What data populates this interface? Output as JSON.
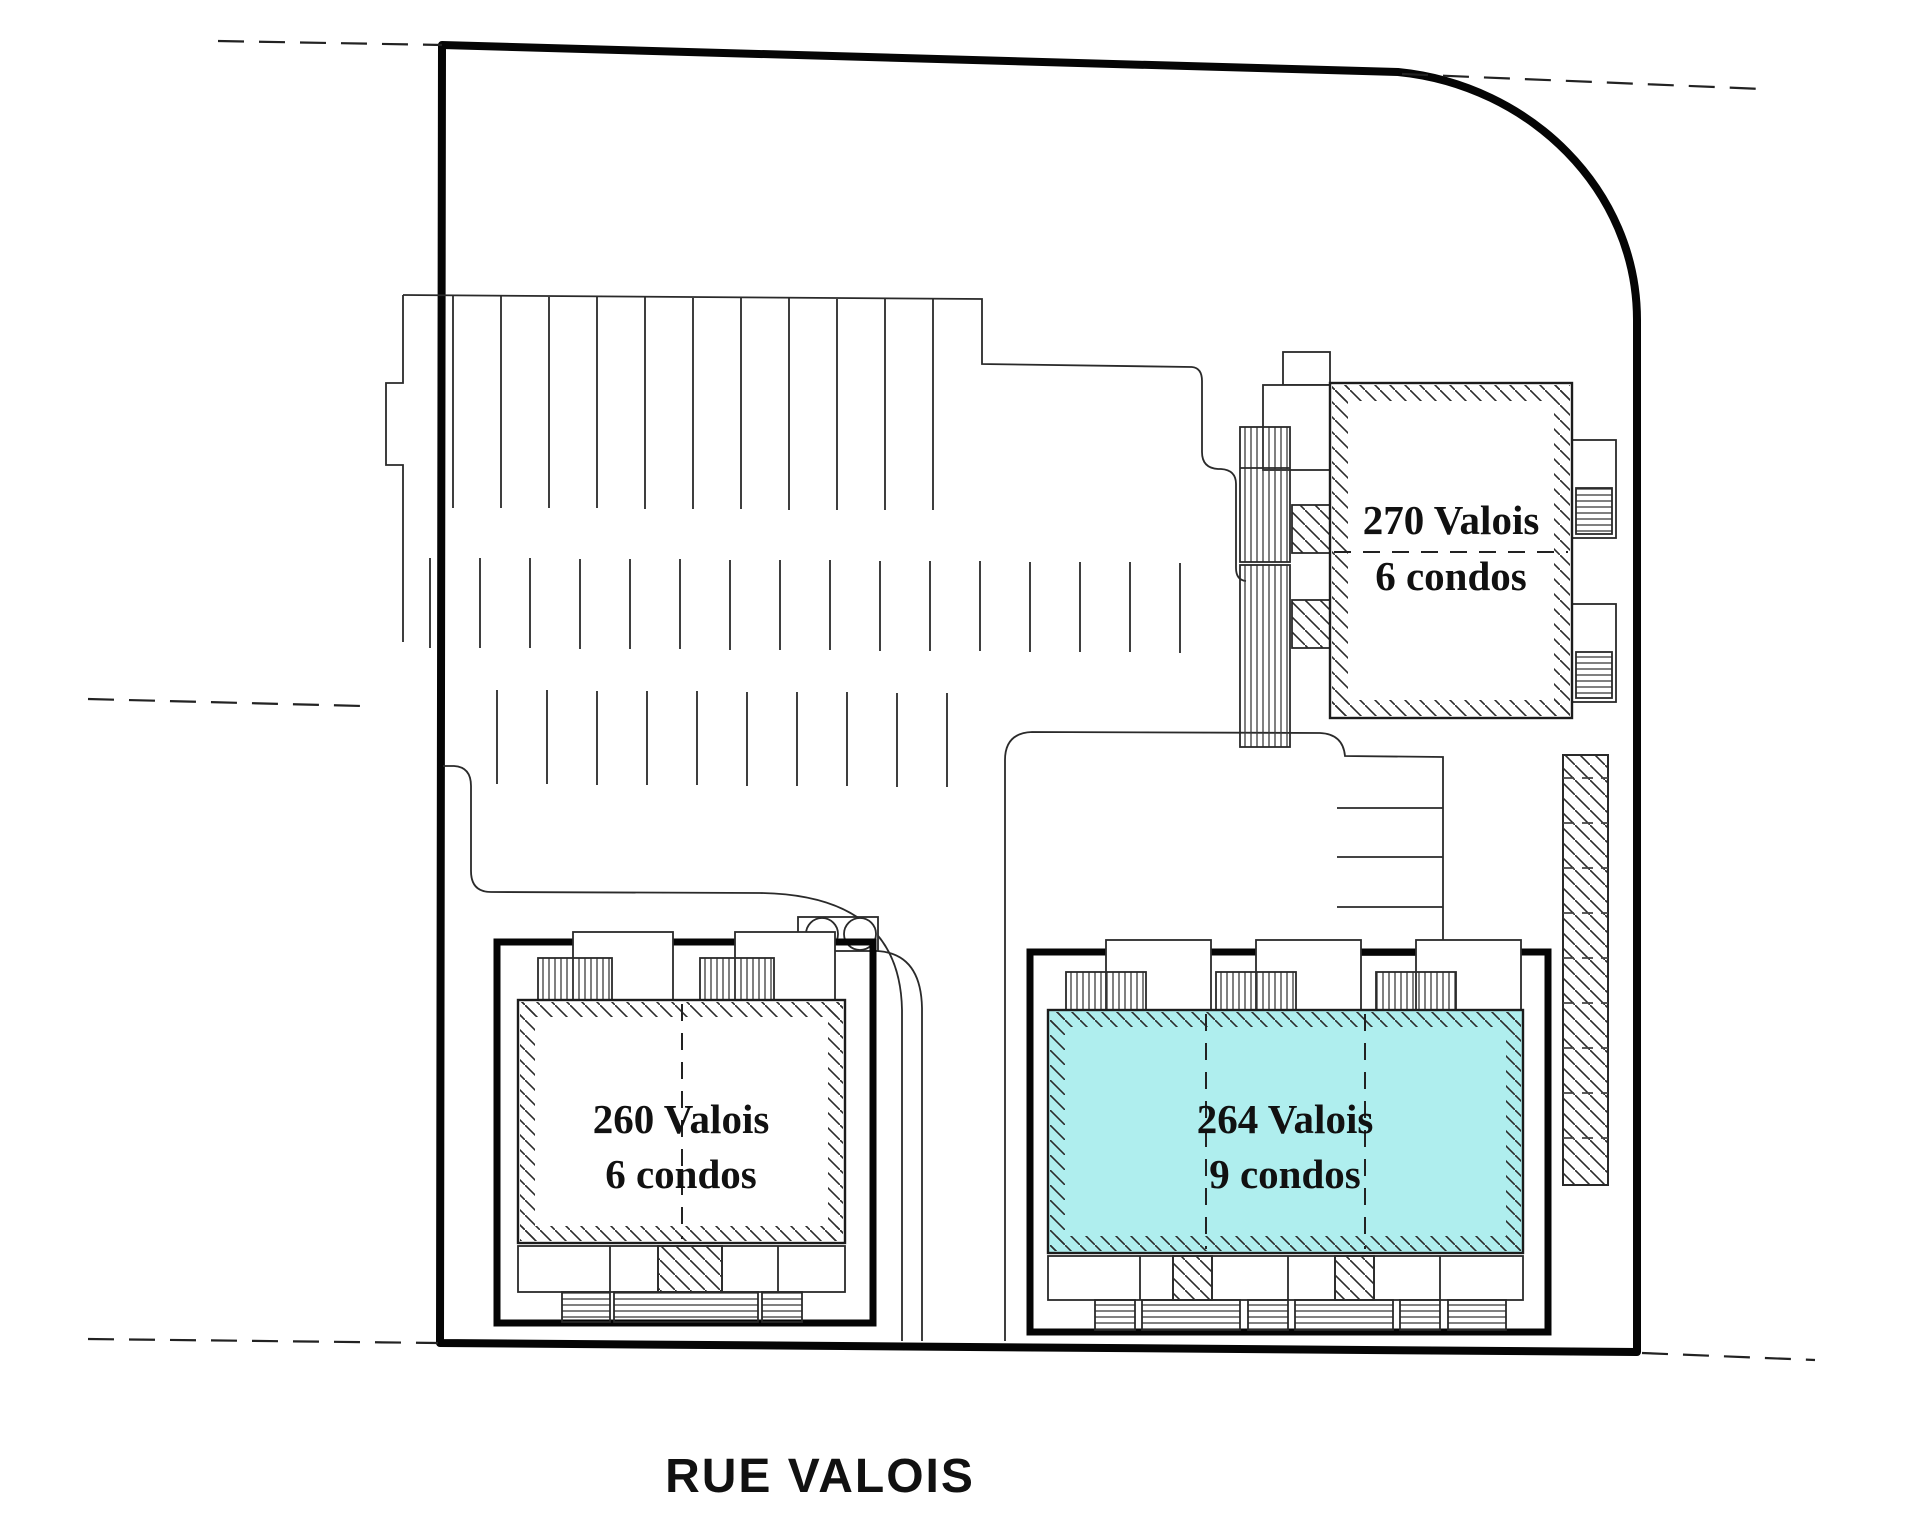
{
  "plan": {
    "street": {
      "label": "RUE VALOIS"
    },
    "colors": {
      "highlight": "#AFEEEE",
      "line": "#111111"
    },
    "buildings": [
      {
        "id": "270-valois",
        "label": "270 Valois",
        "units": "6 condos",
        "highlighted": false
      },
      {
        "id": "260-valois",
        "label": "260 Valois",
        "units": "6 condos",
        "highlighted": false
      },
      {
        "id": "264-valois",
        "label": "264 Valois",
        "units": "9 condos",
        "highlighted": true
      }
    ]
  }
}
